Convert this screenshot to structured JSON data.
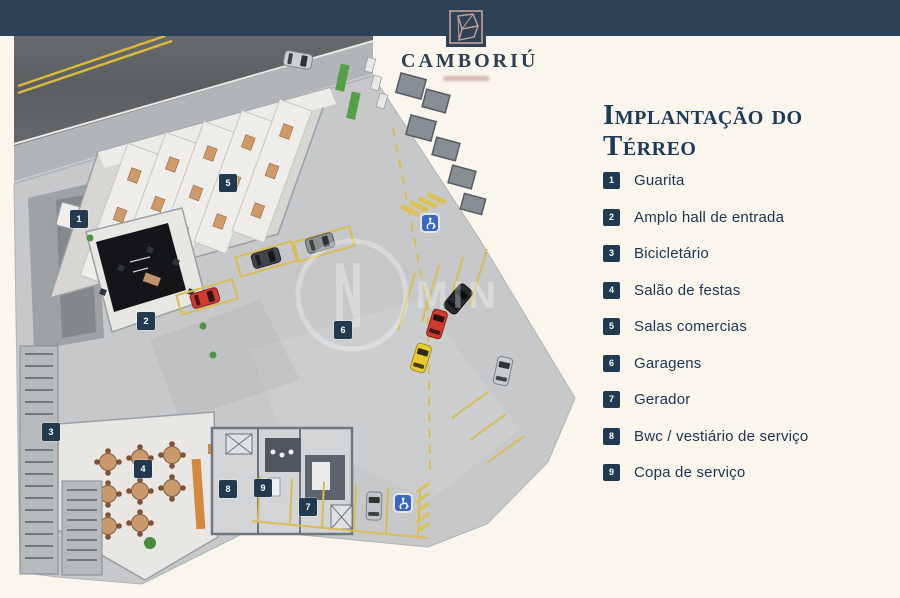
{
  "brand": {
    "name": "CAMBORIÚ"
  },
  "page": {
    "title_line1": "Implantação do",
    "title_line2": "Térreo"
  },
  "legend": {
    "items": [
      {
        "num": "1",
        "label": "Guarita"
      },
      {
        "num": "2",
        "label": "Amplo hall de entrada"
      },
      {
        "num": "3",
        "label": "Bicicletário"
      },
      {
        "num": "4",
        "label": "Salão de festas"
      },
      {
        "num": "5",
        "label": "Salas comercias"
      },
      {
        "num": "6",
        "label": "Garagens"
      },
      {
        "num": "7",
        "label": "Gerador"
      },
      {
        "num": "8",
        "label": "Bwc / vestiário de serviço"
      },
      {
        "num": "9",
        "label": "Copa de serviço"
      }
    ]
  },
  "plan": {
    "watermark": "MIN",
    "badges": [
      {
        "num": "1",
        "x": 79,
        "y": 219
      },
      {
        "num": "2",
        "x": 146,
        "y": 321
      },
      {
        "num": "3",
        "x": 51,
        "y": 432
      },
      {
        "num": "4",
        "x": 143,
        "y": 469
      },
      {
        "num": "5",
        "x": 228,
        "y": 183
      },
      {
        "num": "6",
        "x": 343,
        "y": 330
      },
      {
        "num": "7",
        "x": 308,
        "y": 507
      },
      {
        "num": "8",
        "x": 228,
        "y": 489
      },
      {
        "num": "9",
        "x": 263,
        "y": 488
      }
    ],
    "accessible_marks": [
      {
        "x": 430,
        "y": 223
      },
      {
        "x": 403,
        "y": 503
      }
    ]
  },
  "colors": {
    "navy_bar": "#2e4156",
    "cream_background": "#faf6ee",
    "badge_navy": "#223a4f",
    "title_navy": "#1d3b57",
    "logo_rose": "#c8a29b",
    "parking_yellow": "#d9bd55",
    "accessible_blue": "#3a68c0"
  }
}
